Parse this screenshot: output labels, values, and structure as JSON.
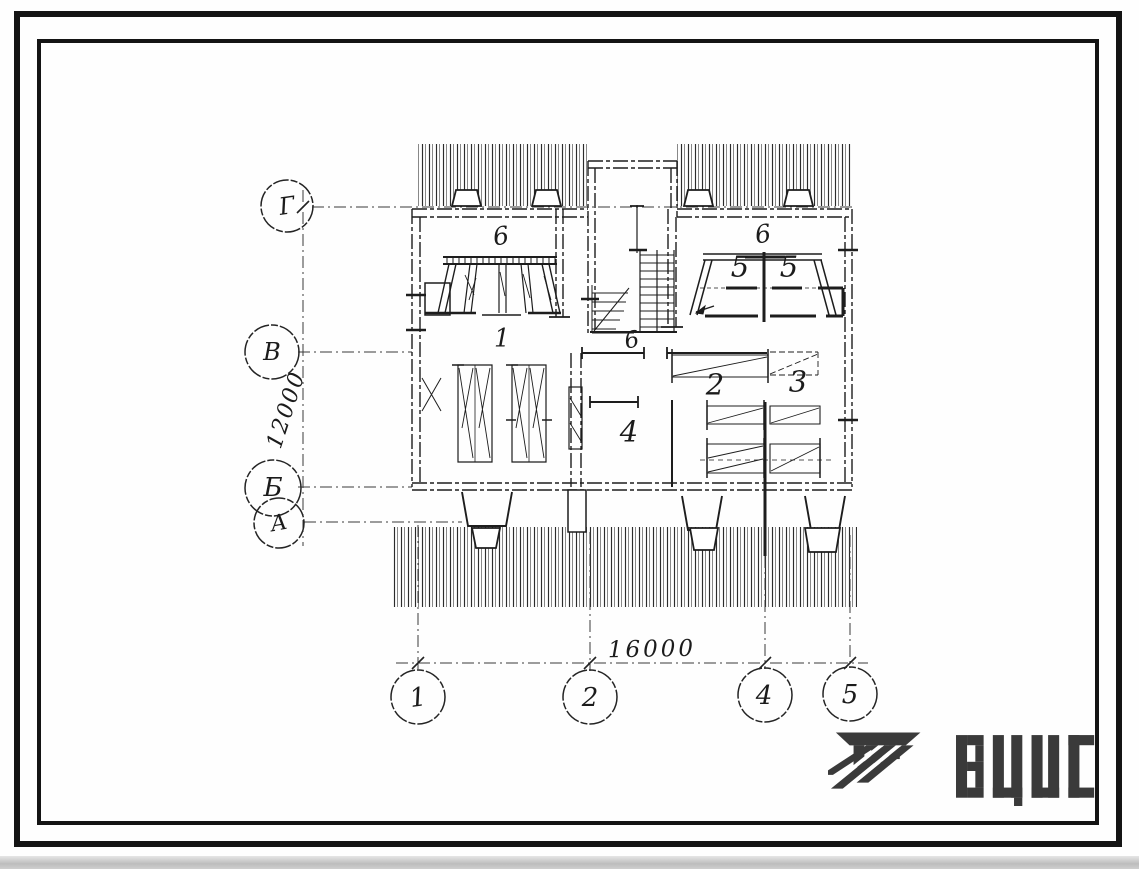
{
  "page": {
    "background": "#ffffff",
    "ink": "#1d1d1d",
    "axis_ink": "#333333"
  },
  "frame": {
    "outer_color": "#141414",
    "inner_color": "#141414"
  },
  "plan": {
    "type": "floor-plan-sketch",
    "axes": {
      "rows": [
        {
          "label": "Г"
        },
        {
          "label": "В"
        },
        {
          "label": "Б"
        },
        {
          "label": "А"
        }
      ],
      "cols": [
        {
          "label": "1"
        },
        {
          "label": "2"
        },
        {
          "label": "4"
        },
        {
          "label": "5"
        }
      ]
    },
    "dimensions": {
      "horizontal": "16000",
      "vertical": "12000"
    },
    "rooms": [
      {
        "label": "6"
      },
      {
        "label": "1"
      },
      {
        "label": "6"
      },
      {
        "label": "6"
      },
      {
        "label": "5"
      },
      {
        "label": "5"
      },
      {
        "label": "2"
      },
      {
        "label": "3"
      },
      {
        "label": "4"
      }
    ]
  },
  "logo": {
    "text": "ВЦИС",
    "color": "#3a3a3a"
  }
}
